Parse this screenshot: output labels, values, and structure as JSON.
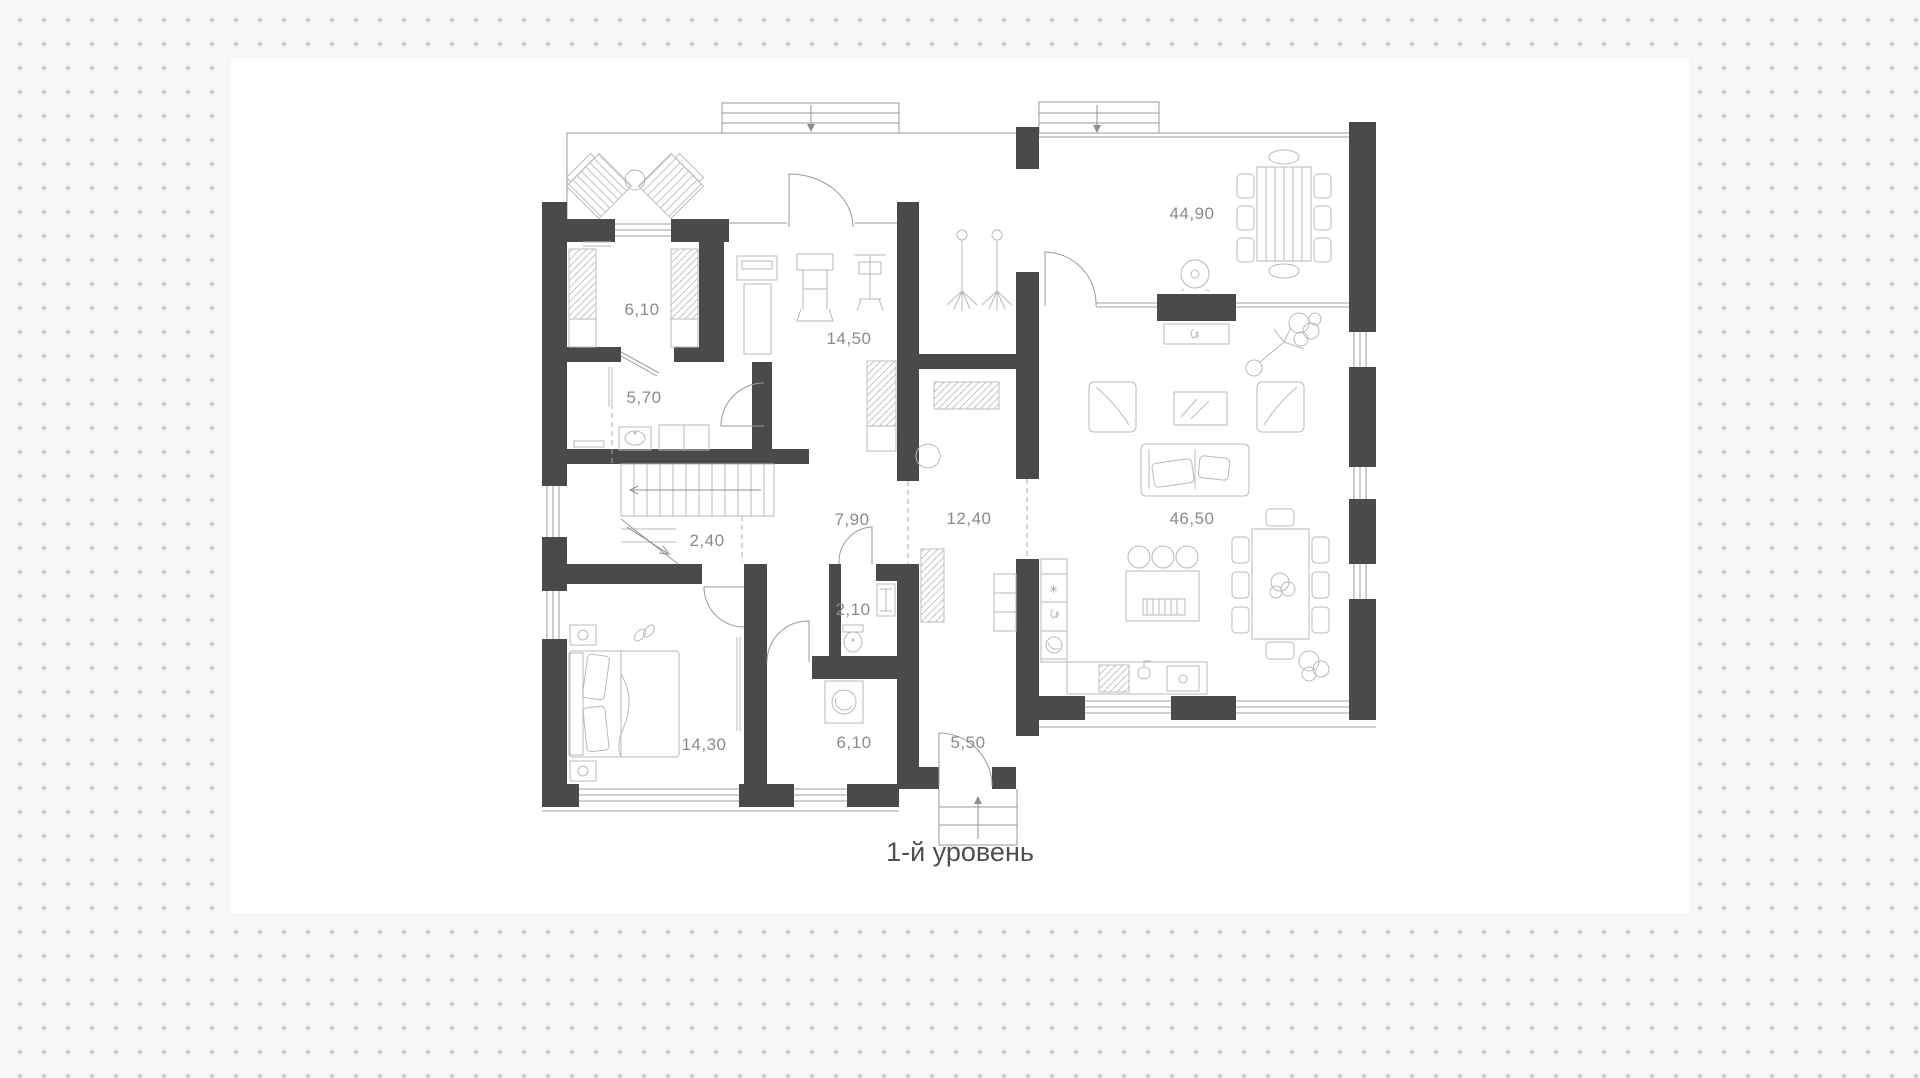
{
  "title": "1-й уровень",
  "plan": {
    "caption": "1-й уровень",
    "rooms": [
      {
        "id": "wardrobe-room",
        "area": "6,10"
      },
      {
        "id": "shower-room",
        "area": "5,70"
      },
      {
        "id": "gym",
        "area": "14,50"
      },
      {
        "id": "dining-room",
        "area": "44,90"
      },
      {
        "id": "stair-hall",
        "area": "2,40"
      },
      {
        "id": "hallway",
        "area": "7,90"
      },
      {
        "id": "corridor",
        "area": "12,40"
      },
      {
        "id": "wc",
        "area": "2,10"
      },
      {
        "id": "living-kitchen",
        "area": "46,50"
      },
      {
        "id": "bedroom",
        "area": "14,30"
      },
      {
        "id": "bathroom",
        "area": "6,10"
      },
      {
        "id": "entrance-hall",
        "area": "5,50"
      }
    ]
  },
  "colors": {
    "background": "#f7f7f7",
    "dot": "#c6c6c6",
    "canvas": "#ffffff",
    "wall": "#4a4a4a",
    "furniture_line": "#b9b9b9",
    "label": "#8a8a8a",
    "caption": "#4f4f4f"
  }
}
